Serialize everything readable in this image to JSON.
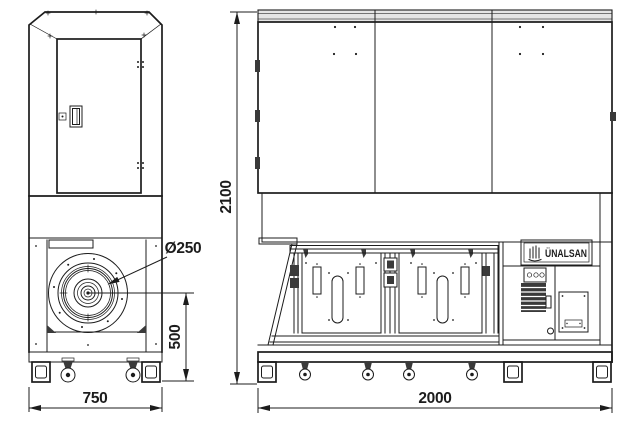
{
  "brand": "ÜNALSAN",
  "dims": {
    "side_width": "750",
    "front_width": "2000",
    "front_height": "2100",
    "fan_center_height": "500",
    "fan_inlet_diameter": "Ø250"
  },
  "colors": {
    "line": "#1c1c1c",
    "background": "#ffffff",
    "band_fill": "#e4e4e4",
    "dark_fill": "#3a3a3a"
  }
}
